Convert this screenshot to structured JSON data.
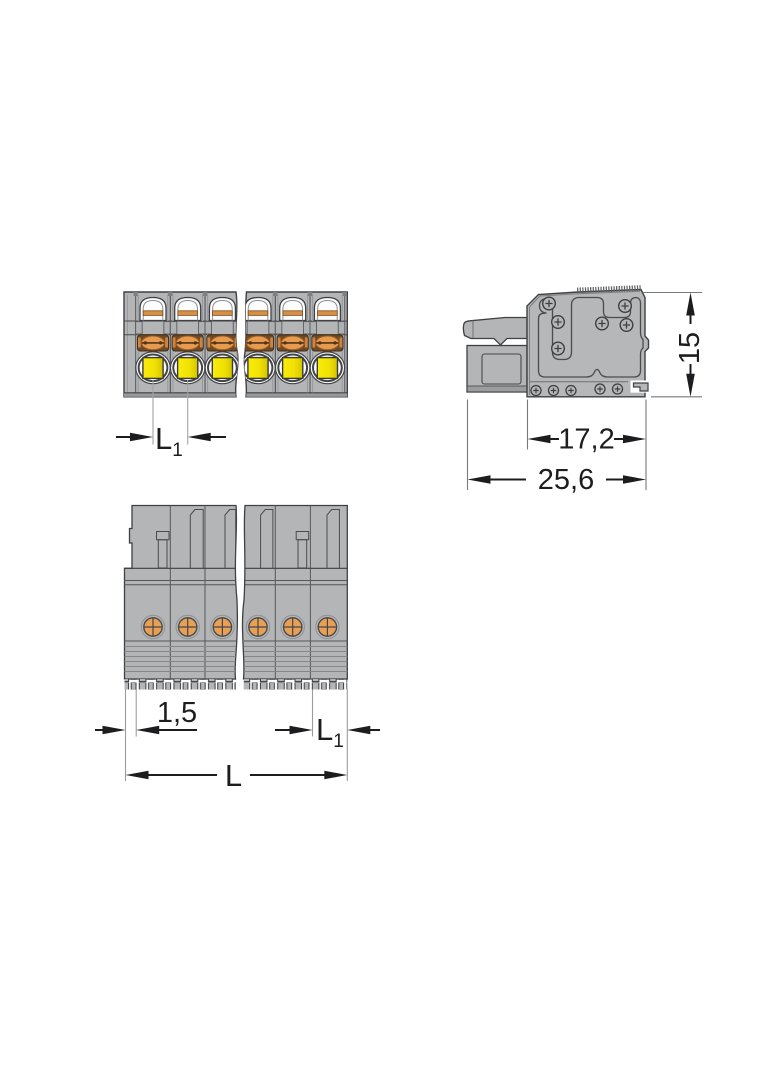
{
  "drawing": {
    "views": {
      "front": {
        "pole_count": 6
      },
      "side": {},
      "bottom": {
        "pole_count": 6
      }
    },
    "dimensions": {
      "front_pitch": {
        "base": "L",
        "sub": "1"
      },
      "side_height": {
        "value": "15"
      },
      "side_body_depth": {
        "value": "17,2"
      },
      "side_total_depth": {
        "value": "25,6"
      },
      "bottom_edge_offset": {
        "value": "1,5"
      },
      "bottom_pitch": {
        "base": "L",
        "sub": "1"
      },
      "bottom_total_length": {
        "value": "L"
      }
    },
    "colors": {
      "background": "#ffffff",
      "body_gray": "#b3b5b7",
      "outline_dark": "#3f4042",
      "clamp_orange": "#e69b4e",
      "clamp_brown": "#6b4a28",
      "button_yellow": "#f2e205",
      "screw_orange": "#e8a057",
      "dimension_ink": "#1d1d1f"
    }
  }
}
